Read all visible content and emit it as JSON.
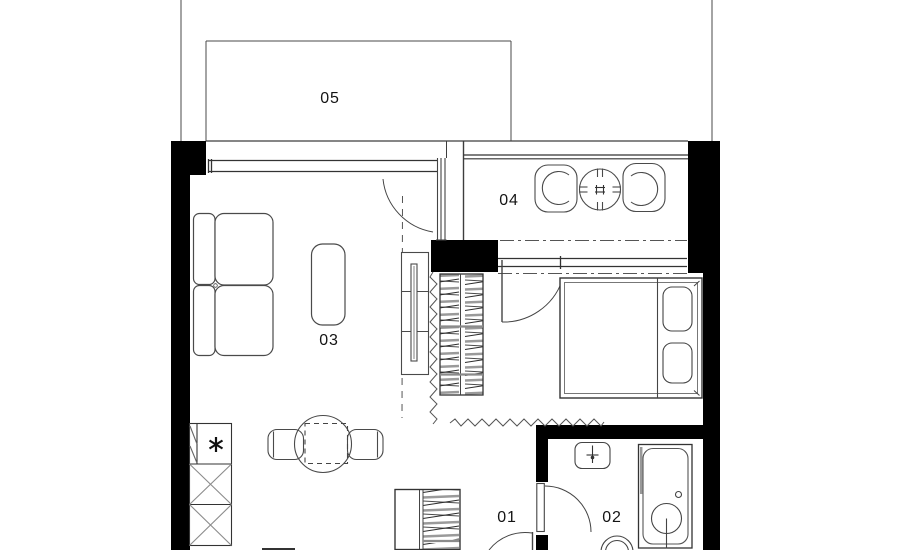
{
  "plan": {
    "room_labels": [
      {
        "room": "hallway",
        "label": "01"
      },
      {
        "room": "bathroom",
        "label": "02"
      },
      {
        "room": "living-room",
        "label": "03"
      },
      {
        "room": "loggia",
        "label": "04"
      },
      {
        "room": "balcony",
        "label": "05"
      }
    ],
    "colors": {
      "background": "#ffffff",
      "walls": "#000000",
      "outline": "#3d3d3d",
      "furniture": "#4a4a4a",
      "gray_detail": "#8b8b8b",
      "label_text": "#141414"
    },
    "symbols": {
      "fridge_marker": "asterisk",
      "wardrobe_fill": "hanging-rail-hatch",
      "flexible_partition": "zigzag-line"
    }
  }
}
